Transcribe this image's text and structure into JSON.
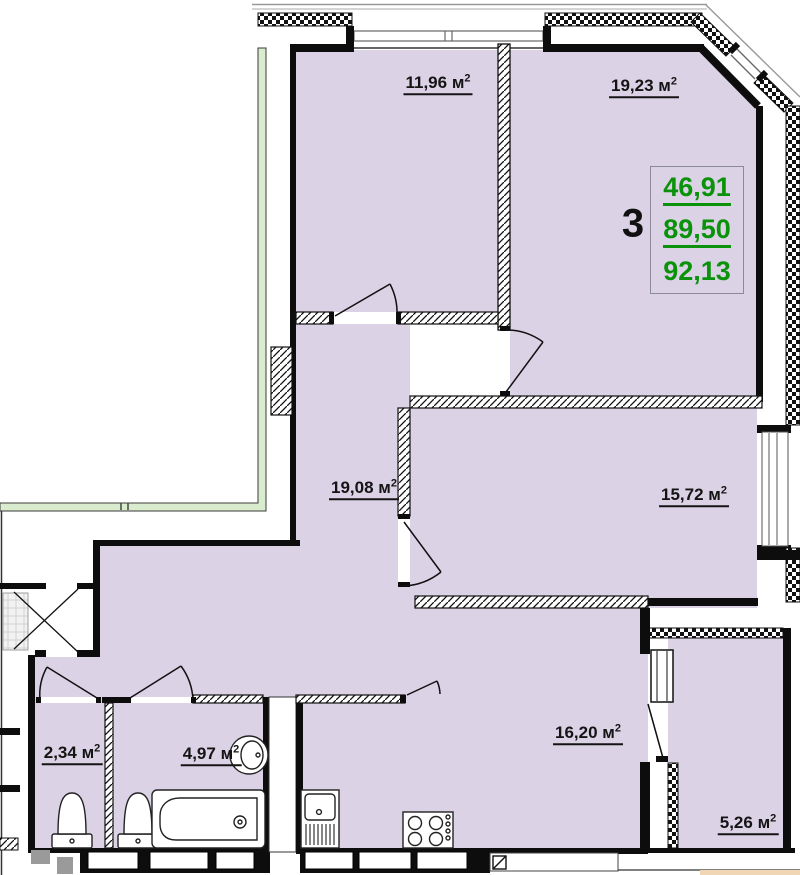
{
  "units": {
    "m": "м",
    "sup": "2"
  },
  "rooms": [
    {
      "name": "bedroom-1",
      "area": "11,96"
    },
    {
      "name": "living-room",
      "area": "19,23"
    },
    {
      "name": "hallway",
      "area": "19,08"
    },
    {
      "name": "bedroom-2",
      "area": "15,72"
    },
    {
      "name": "kitchen-living",
      "area": "16,20"
    },
    {
      "name": "wc",
      "area": "2,34"
    },
    {
      "name": "bathroom",
      "area": "4,97"
    },
    {
      "name": "balcony",
      "area": "5,26"
    }
  ],
  "summary": {
    "rooms_count": "3",
    "living_area": "46,91",
    "apartment_area": "89,50",
    "total_area": "92,13"
  },
  "colors": {
    "floor": "#dcd2e6",
    "adjacent_outline": "#d9ecce",
    "green_text": "#0a930a",
    "wall": "#0d0d0d"
  }
}
